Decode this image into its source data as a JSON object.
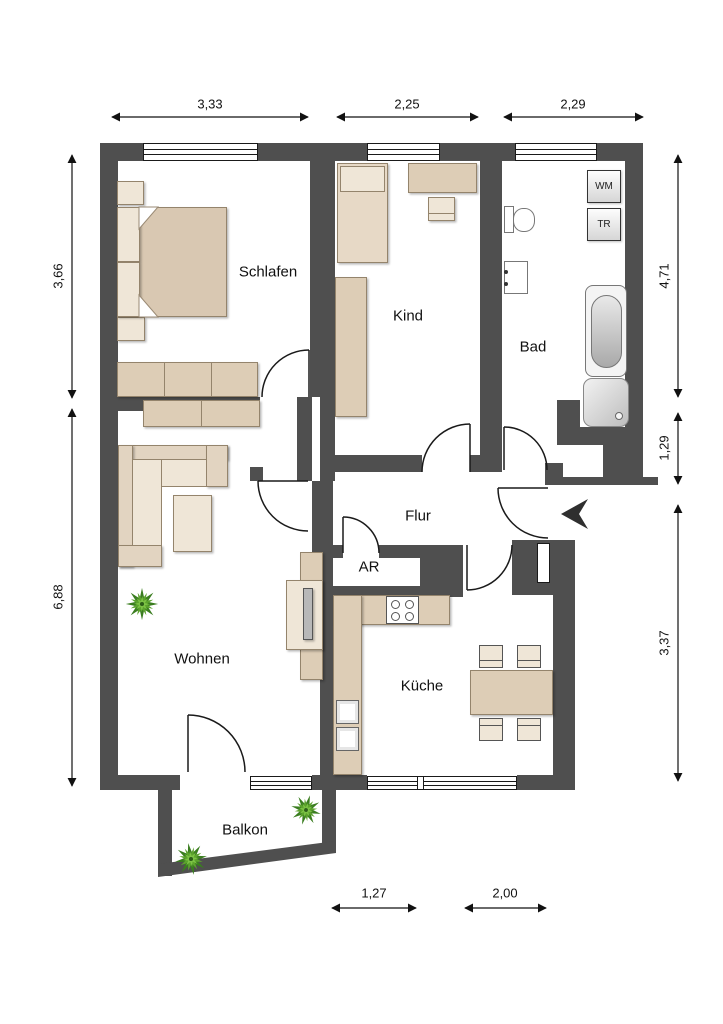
{
  "floorplan": {
    "rooms": [
      {
        "id": "schlafen",
        "label": "Schlafen"
      },
      {
        "id": "kind",
        "label": "Kind"
      },
      {
        "id": "bad",
        "label": "Bad"
      },
      {
        "id": "flur",
        "label": "Flur"
      },
      {
        "id": "abstellraum",
        "label": "AR"
      },
      {
        "id": "wohnen",
        "label": "Wohnen"
      },
      {
        "id": "kueche",
        "label": "Küche"
      },
      {
        "id": "balkon",
        "label": "Balkon"
      }
    ],
    "appliances": {
      "washing_machine": "WM",
      "dryer": "TR"
    },
    "dimensions": {
      "top": [
        {
          "label": "3,33"
        },
        {
          "label": "2,25"
        },
        {
          "label": "2,29"
        }
      ],
      "left": [
        {
          "label": "3,66"
        },
        {
          "label": "6,88"
        }
      ],
      "right": [
        {
          "label": "4,71"
        },
        {
          "label": "1,29"
        },
        {
          "label": "3,37"
        }
      ],
      "bottom": [
        {
          "label": "1,27"
        },
        {
          "label": "2,00"
        }
      ]
    },
    "colors": {
      "wall": "#4f4f4f",
      "furniture": "#ddcdb6",
      "furniture_light": "#efe6d7",
      "fixture_border": "#777777",
      "plant_dark": "#3a7d1f",
      "plant_mid": "#5ca32d",
      "plant_light": "#7cc244",
      "dimension": "#111111"
    }
  }
}
